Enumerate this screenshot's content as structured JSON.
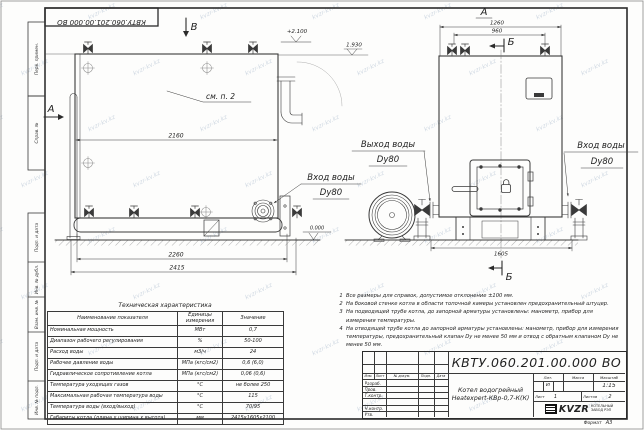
{
  "sheet": {
    "doc_number": "КВТУ.060.201.00.000 ВО",
    "format_label": "Формат",
    "format_value": "А3",
    "watermark": "kvzr-kv.kz"
  },
  "frame": {
    "stamp_top_1": "Перв. примен.",
    "stamp_top_2": "Справ. №",
    "stamp_bottom_1": "Подп. и дата",
    "stamp_bottom_2": "Инв. № дубл.",
    "stamp_bottom_3": "Взам. инв. №",
    "stamp_bottom_4": "Подп. и дата",
    "stamp_bottom_5": "Инв. № подл."
  },
  "drawing": {
    "view_b_marker": "В",
    "view_a_marker": "А",
    "view_a_label": "А",
    "section_b_top": "Б",
    "section_b_bottom": "Б",
    "see_note": "см. п. 2",
    "elev_top": "+2.100",
    "elev_mid": "1.930",
    "elev_zero": "0.000",
    "dim_2160": "2160",
    "dim_2260": "2260",
    "dim_2415": "2415",
    "dim_1260": "1260",
    "dim_960": "960",
    "dim_1605": "1605",
    "outlet_line1": "Выход воды",
    "outlet_line2": "Dy80",
    "inlet_side_line1": "Вход воды",
    "inlet_side_line2": "Dy80",
    "inlet_front_line1": "Вход воды",
    "inlet_front_line2": "Dy80"
  },
  "tech_table": {
    "title": "Техническая характеристика",
    "headers": [
      "Наименование показателя",
      "Единицы измерения",
      "Значение"
    ],
    "rows": [
      [
        "Номинальная мощность",
        "МВт",
        "0,7"
      ],
      [
        "Диапазон рабочего регулирования",
        "%",
        "50-100"
      ],
      [
        "Расход воды",
        "м3/ч",
        "24"
      ],
      [
        "Рабочее давление воды",
        "МПа (кгс/см2)",
        "0,6 (6,0)"
      ],
      [
        "Гидравлическое сопротивление котла",
        "МПа (кгс/см2)",
        "0,06 (0,6)"
      ],
      [
        "Температура уходящих газов",
        "°С",
        "не более 250"
      ],
      [
        "Максимальная рабочая температура воды",
        "°С",
        "115"
      ],
      [
        "Температура воды (вход/выход)",
        "°С",
        "70/95"
      ],
      [
        "Габариты котла (длина х ширина х высота)",
        "мм",
        "2415х1605х2100"
      ]
    ]
  },
  "notes": [
    {
      "n": "1",
      "text": "Все размеры для справок, допустимое отклонение ±100 мм."
    },
    {
      "n": "2",
      "text": "На боковой стенке котла в области топочной камеры установлен предохранительный штуцер."
    },
    {
      "n": "3",
      "text": "На  подводящей трубе котла, до запорной арматуры установлены: манометр, прибор для измерения температуры."
    },
    {
      "n": "4",
      "text": "На отводящей трубе котла до запорной арматуры установлены: манометр, прибор для измерения температуры, предохранительный клапан Dу не менее 50 мм и отвод с обратным клапаном Dу не менее 50 мм."
    }
  ],
  "title_block": {
    "doc_number": "КВТУ.060.201.00.000 ВО",
    "product_line1": "Котел водогрейный",
    "product_line2": "Heatexpert-КВр-0,7-К(К)",
    "col_izm": "Изм.",
    "col_list": "Лист",
    "col_docnum": "№ докум.",
    "col_podp": "Подп.",
    "col_data": "Дата",
    "row_razrab": "Разраб.",
    "row_prov": "Пров.",
    "row_tkontr": "Т.контр.",
    "row_nkontr": "Н.контр.",
    "row_utv": "Утв.",
    "lit_label": "Лит.",
    "mass_label": "Масса",
    "scale_label": "Масштаб",
    "lit_value": "И",
    "scale_value": "1:15",
    "sheet_label": "Лист",
    "sheet_value": "1",
    "sheets_label": "Листов",
    "sheets_value": "2",
    "logo_text": "KVZR",
    "company_line1": "КОТЕЛЬНЫЙ",
    "company_line2": "ЗАВОД РЭП"
  }
}
